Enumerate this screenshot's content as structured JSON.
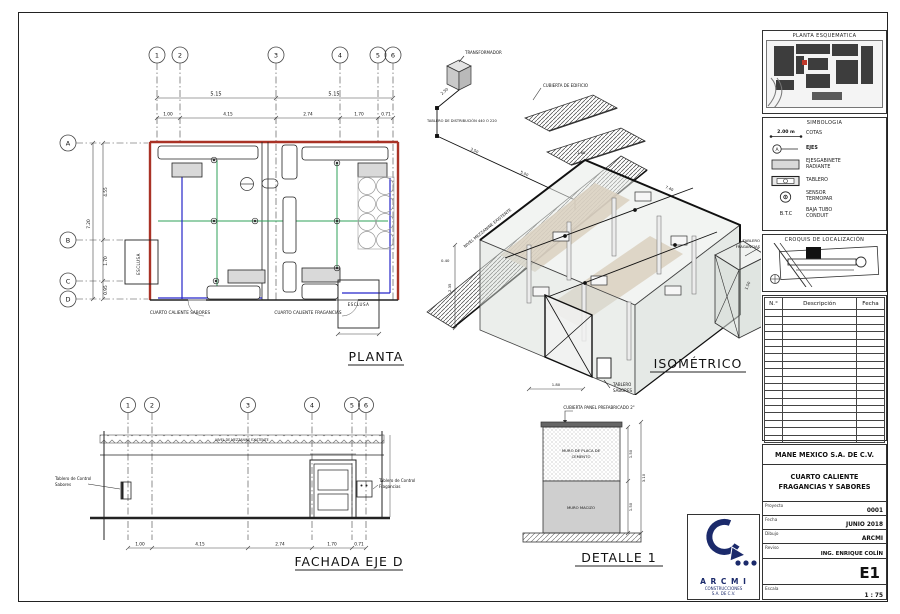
{
  "planta": {
    "title": "PLANTA",
    "axes_top": [
      "1",
      "2",
      "3",
      "4",
      "5",
      "6"
    ],
    "axes_left": [
      "A",
      "B",
      "C",
      "D"
    ],
    "dims_top": [
      "5.15",
      "5.15"
    ],
    "dims_mid": [
      "1.00",
      "4.15",
      "2.74",
      "1.70",
      "0.71"
    ],
    "dim_total_v": "7.20",
    "dims_left_v": [
      "4.55",
      "1.70",
      "0.95"
    ],
    "room_left": "CUARTO CALIENTE SABORES",
    "room_right": "CUARTO CALIENTE FRAGANCIAS",
    "esclusa": "ESCLUSA"
  },
  "isometrico": {
    "title": "ISOMÉTRICO",
    "transformador": "TRANSFORMADOR",
    "tablero_dist": "TABLERO DE DISTRIBUCIÓN 440 O 220",
    "cubierta": "CUBIERTA DE EDIFICIO",
    "nivel": "NIVEL MEZZANINE EXISTENTE",
    "tablero_frag_1": "TABLERO",
    "tablero_frag_2": "FRAGANCIAS",
    "tablero_sab_1": "TABLERO",
    "tablero_sab_2": "SABORES",
    "dims": {
      "d250": "2.50",
      "d350": "3.50",
      "d500": "5.00",
      "d160": "1.60",
      "d740": "7.40",
      "d040": "0.40",
      "d235": "2.35",
      "d180": "1.80",
      "d150": "1.50"
    }
  },
  "fachada": {
    "title": "FACHADA EJE D",
    "axes": [
      "1",
      "2",
      "3",
      "4",
      "5",
      "6"
    ],
    "dims": [
      "1.00",
      "4.15",
      "2.74",
      "1.70",
      "0.71"
    ],
    "roof_label": "NIVEL DE MEZZANINE EXISTENTE",
    "label_left_1": "Tablero de Control",
    "label_left_2": "Sabores",
    "label_right_1": "Tablero de Control",
    "label_right_2": "Fragancias"
  },
  "detalle": {
    "title": "DETALLE 1",
    "top_label": "CUBIERTA PANEL PREFABRICADO 2\"",
    "upper_1": "MURO DE PLACA DE",
    "upper_2": "CEMENTO",
    "lower": "MURO MACIZO",
    "dim_upper": "1.50",
    "dim_lower": "1.50",
    "dim_total": "3.10"
  },
  "sidebar": {
    "site_title": "PLANTA ESQUEMATICA",
    "simb_title": "SIMBOLOGIA",
    "simb": {
      "cota_sample": "2.00 m",
      "cota": "COTAS",
      "eje_sample": "A",
      "eje": "EJES",
      "gabinete_1": "EJESGABINETE",
      "gabinete_2": "RADIANTE",
      "tablero": "TABLERO",
      "sensor_1": "SENSOR",
      "sensor_2": "TERMOPAR",
      "btc_sample": "B.T.C",
      "btc_1": "BAJA TUBO",
      "btc_2": "CONDUIT"
    },
    "croquis_title": "CROQUIS DE LOCALIZACIÓN",
    "table": {
      "col_num": "N.°",
      "col_desc": "Descripción",
      "col_fecha": "Fecha"
    },
    "titleblock": {
      "company": "MANE MEXICO S.A. DE C.V.",
      "project_1": "CUARTO CALIENTE",
      "project_2": "FRAGANCIAS Y SABORES",
      "f1_label": "Proyecto",
      "f1_value": "0001",
      "f2_label": "Fecha",
      "f2_value": "JUNIO 2018",
      "f3_label": "Dibujo",
      "f3_value": "ARCMI",
      "f4_label": "Reviso",
      "f4_value": "ING. ENRIQUE COLÍN",
      "sheet": "E1",
      "f5_label": "Escala",
      "f5_value": "1 : 75"
    },
    "logo": {
      "name": "A R C M I",
      "line2": "CONSTRUCCIONES",
      "line3": "S.A. DE C.V."
    }
  }
}
